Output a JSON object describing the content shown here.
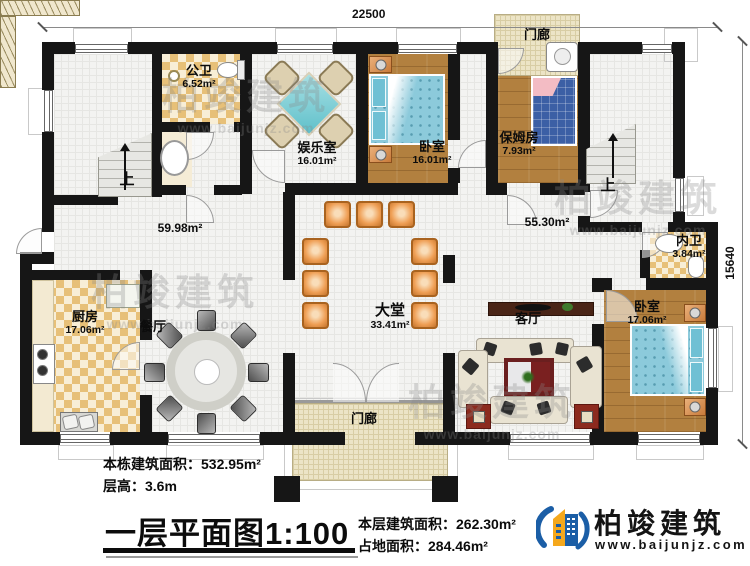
{
  "plan": {
    "dim_top": "22500",
    "dim_right": "15640",
    "stairs_up_label": "上",
    "rooms": {
      "gongwei": {
        "name": "公卫",
        "area": "6.52m²"
      },
      "yuleshi": {
        "name": "娱乐室",
        "area": "16.01m²"
      },
      "woshi_top": {
        "name": "卧室",
        "area": "16.01m²"
      },
      "baomufang": {
        "name": "保姆房",
        "area": "7.93m²"
      },
      "menlang_top": {
        "name": "门廊"
      },
      "neiwei": {
        "name": "内卫",
        "area": "3.84m²"
      },
      "woshi_right": {
        "name": "卧室",
        "area": "17.06m²"
      },
      "keting": {
        "name": "客厅"
      },
      "datang": {
        "name": "大堂",
        "area": "33.41m²"
      },
      "canting": {
        "name": "餐厅"
      },
      "chufang": {
        "name": "厨房",
        "area": "17.06m²"
      },
      "menlang_bottom": {
        "name": "门廊"
      },
      "hall_left_area": "59.98m²",
      "hall_right_area": "55.30m²"
    }
  },
  "info": {
    "building": {
      "label": "本栋建筑面积：",
      "value": "532.95m²"
    },
    "height": {
      "label": "层高：",
      "value": "3.6m"
    },
    "floor": {
      "label": "本层建筑面积：",
      "value": "262.30m²"
    },
    "land": {
      "label": "占地面积：",
      "value": "284.46m²"
    }
  },
  "title_block": {
    "name": "一层平面图",
    "scale": "1:100"
  },
  "logo": {
    "name": "柏竣建筑",
    "site": "www.baijunjz.com"
  },
  "watermark": {
    "name": "柏竣建筑",
    "site": "www.baijunjz.com"
  },
  "colors": {
    "wall": "#161616",
    "wood": "#b2803f",
    "checker": "#e7c078",
    "tile": "#f3f3f1",
    "porch": "#ece4c6",
    "bed_blue": "#8ccadb",
    "chair_orange": "#ef9f55",
    "logo_blue": "#1b5ea6",
    "logo_orange": "#f5a81c"
  }
}
